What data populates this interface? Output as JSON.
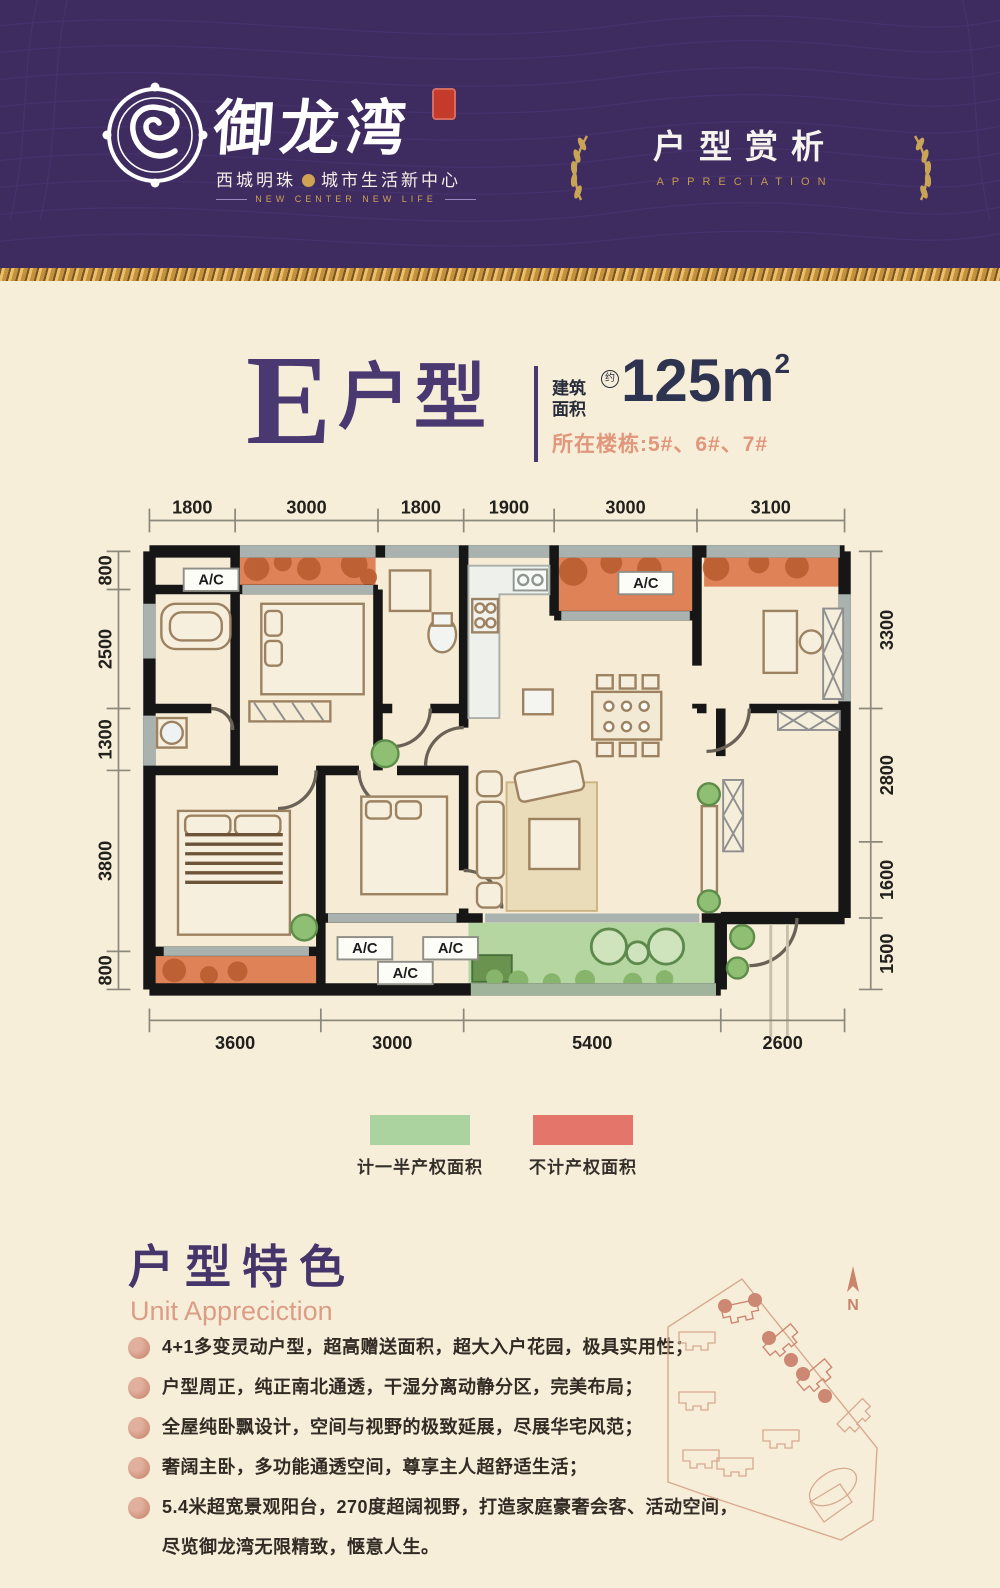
{
  "header": {
    "logo": {
      "name": "御龙湾",
      "tagline_left": "西城明珠",
      "tagline_right": "城市生活新中心",
      "subtitle": "NEW CENTER  NEW LIFE"
    },
    "banner": {
      "title": "户型赏析",
      "subtitle": "APPRECIATION"
    }
  },
  "unit": {
    "letter": "E",
    "name": "户型",
    "area_label1": "建筑",
    "area_label2": "面积",
    "approx": "约",
    "area_value": "125m",
    "area_sup": "2",
    "buildings": "所在楼栋:5#、6#、7#"
  },
  "plan": {
    "dims_top": [
      "1800",
      "3000",
      "1800",
      "1900",
      "3000",
      "3100"
    ],
    "dims_left": [
      "800",
      "2500",
      "1300",
      "3800",
      "800"
    ],
    "dims_right": [
      "3300",
      "2800",
      "1600",
      "1500"
    ],
    "dims_bottom": [
      "3600",
      "3000",
      "5400",
      "2600"
    ],
    "ac_labels": [
      "A/C",
      "A/C",
      "A/C",
      "A/C",
      "A/C"
    ]
  },
  "legend": {
    "half_label": "计一半产权面积",
    "none_label": "不计产权面积"
  },
  "features": {
    "title": "户型特色",
    "subtitle": "Unit Appreciction",
    "items": [
      "4+1多变灵动户型，超高赠送面积，超大入户花园，极具实用性；",
      "户型周正，纯正南北通透，干湿分离动静分区，完美布局；",
      "全屋纯卧飘设计，空间与视野的极致延展，尽展华宅风范；",
      "奢阔主卧，多功能通透空间，尊享主人超舒适生活；",
      "5.4米超宽景观阳台，270度超阔视野，打造家庭豪奢会客、活动空间，"
    ],
    "item_cont": "尽览御龙湾无限精致，惬意人生。"
  },
  "siteplan": {
    "north_label": "N"
  },
  "colors": {
    "header_purple": "#3e2b60",
    "accent_purple": "#4a3870",
    "salmon": "#e0977b",
    "gold": "#c9a457",
    "legend_green": "#abd3a0",
    "legend_red": "#e4756b",
    "balcony_orange": "#e08257",
    "balcony_green": "#b6d6a1"
  }
}
